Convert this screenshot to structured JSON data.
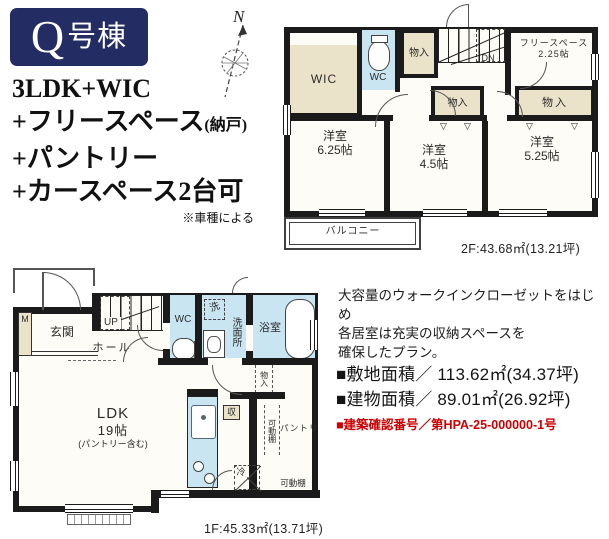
{
  "badge": {
    "q": "Q",
    "suffix": "号棟"
  },
  "features": {
    "line1": "3LDK+WIC",
    "line2": "+フリースペース",
    "line2_note": "(納戸)",
    "line3": "+パントリー",
    "line4": "+カースペース2台可",
    "note": "※車種による"
  },
  "compass": {
    "label": "N"
  },
  "floor2": {
    "wic": "WIC",
    "wc": "WC",
    "storage_top": "物入",
    "storage_mid": "物入",
    "storage_right": "物入",
    "free_name": "フリースペース",
    "free_size": "2.25帖",
    "dn": "DN",
    "bed1_name": "洋室",
    "bed1_size": "6.25帖",
    "bed2_name": "洋室",
    "bed2_size": "4.5帖",
    "bed3_name": "洋室",
    "bed3_size": "5.25帖",
    "balcony": "バルコニー",
    "area": "2F:43.68㎡(13.21坪)"
  },
  "floor1": {
    "meter": "M",
    "entrance": "玄関",
    "up": "UP",
    "hall": "ホール",
    "wc": "WC",
    "laundry": "洗",
    "washroom": "洗面所",
    "bath": "浴室",
    "closet_strip": "物入",
    "ldk": "LDK",
    "ldk_size": "19帖",
    "ldk_note": "(パントリー含む)",
    "storage": "収",
    "fridge": "冷",
    "pantry": "パントリ",
    "shelf_v": "可動棚",
    "shelf_h": "可動棚",
    "area": "1F:45.33㎡(13.71坪)"
  },
  "description": {
    "line1": "大容量のウォークインクローゼットをはじめ",
    "line2": "各居室は充実の収納スペースを",
    "line3": "確保したプラン。"
  },
  "facts": {
    "site_label": "■敷地面積／",
    "site_value": "113.62㎡(34.37坪)",
    "building_label": "■建物面積／",
    "building_value": "89.01㎡(26.92坪)",
    "permit": "■建築確認番号／第HPA-25-000000-1号"
  },
  "icons": {
    "pole_triangle": "▽"
  },
  "colors": {
    "navy": "#232d64",
    "beige": "#eae3c9",
    "blue": "#c9e5f2",
    "wall": "#1b1b1b",
    "red": "#cc0000"
  }
}
